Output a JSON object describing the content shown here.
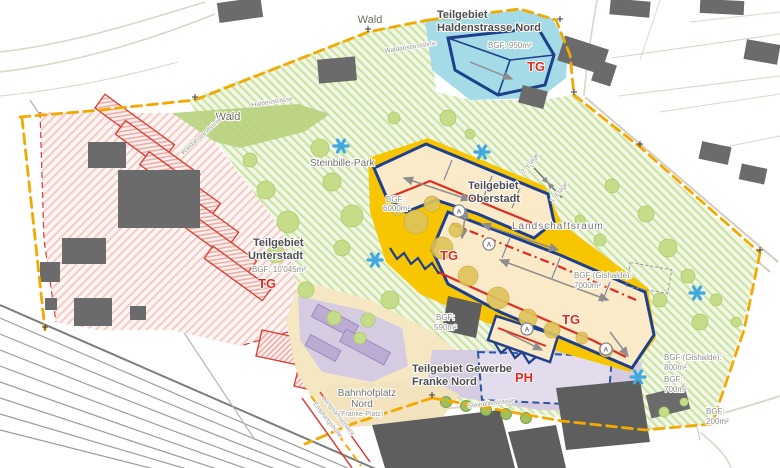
{
  "zones": {
    "haldenstrasse_nord": {
      "name_line1": "Teilgebiet",
      "name_line2": "Haldenstrasse Nord",
      "bgf": "BGF: 950m²",
      "marker": "TG"
    },
    "oberstadt": {
      "name_line1": "Teilgebiet",
      "name_line2": "Oberstadt",
      "bgf_line1": "BGF:",
      "bgf_line2": "6000m²",
      "bgf_gishalde_line1": "BGF (Gishalde):",
      "bgf_gishalde_line2": "7000m²",
      "marker_upper": "TG",
      "marker_lower": "TG"
    },
    "unterstadt": {
      "name_line1": "Teilgebiet",
      "name_line2": "Unterstadt",
      "bgf": "BGF: 10'045m²",
      "marker": "TG"
    },
    "gewerbe_franke_nord": {
      "name_line1": "Teilgebiet Gewerbe",
      "name_line2": "Franke Nord",
      "marker": "PH"
    }
  },
  "labels": {
    "wald_top": "Wald",
    "wald_left": "Wald",
    "waldabstandslinie_top": "Waldabstandslinie",
    "waldabstandslinie_left": "Waldabstandslinie",
    "haldenstrasse_street": "Haldenstrasse",
    "steinbille_park": "Steinbille-Park",
    "landschaftsraum": "Landschaftsraum",
    "bahnhofplatz_line1": "Bahnhofplatz",
    "bahnhofplatz_line2": "Nord",
    "bahnhofplatz_sub": "(Franke-Platz)",
    "steinbillestrasse_street": "Steinbillestrasse",
    "etage_upper": "2. Etage",
    "etage_lower": "1. Etage",
    "empfangshalle": "Empfangshalle",
    "langsamverkehr": "Langsamverkehr",
    "bgf_590_line1": "BGF:",
    "bgf_590_line2": "590m²",
    "bgf_800_line1": "BGF (Gishalde):",
    "bgf_800_line2": "800m²",
    "bgf_700_line1": "BGF:",
    "bgf_700_line2": "700m²",
    "bgf_200_line1": "BGF:",
    "bgf_200_line2": "200m²"
  },
  "markers": {
    "access_point": "A"
  },
  "colors": {
    "boundary_orange": "#F2A900",
    "navy_outline": "#1E3F8C",
    "accent_red": "#E02A1E",
    "zone_cyan": "#A5DBE6",
    "zone_yellow": "#F7C600",
    "zone_purple": "#D6CCE2",
    "zone_pink_hatch": "#F2C7C1",
    "green_hatch": "#CBE3A2",
    "asterisk_blue": "#3FA9E0",
    "building_gray": "#646464",
    "label_gray": "#8F8F88",
    "title_gray": "#4D4D4D"
  }
}
